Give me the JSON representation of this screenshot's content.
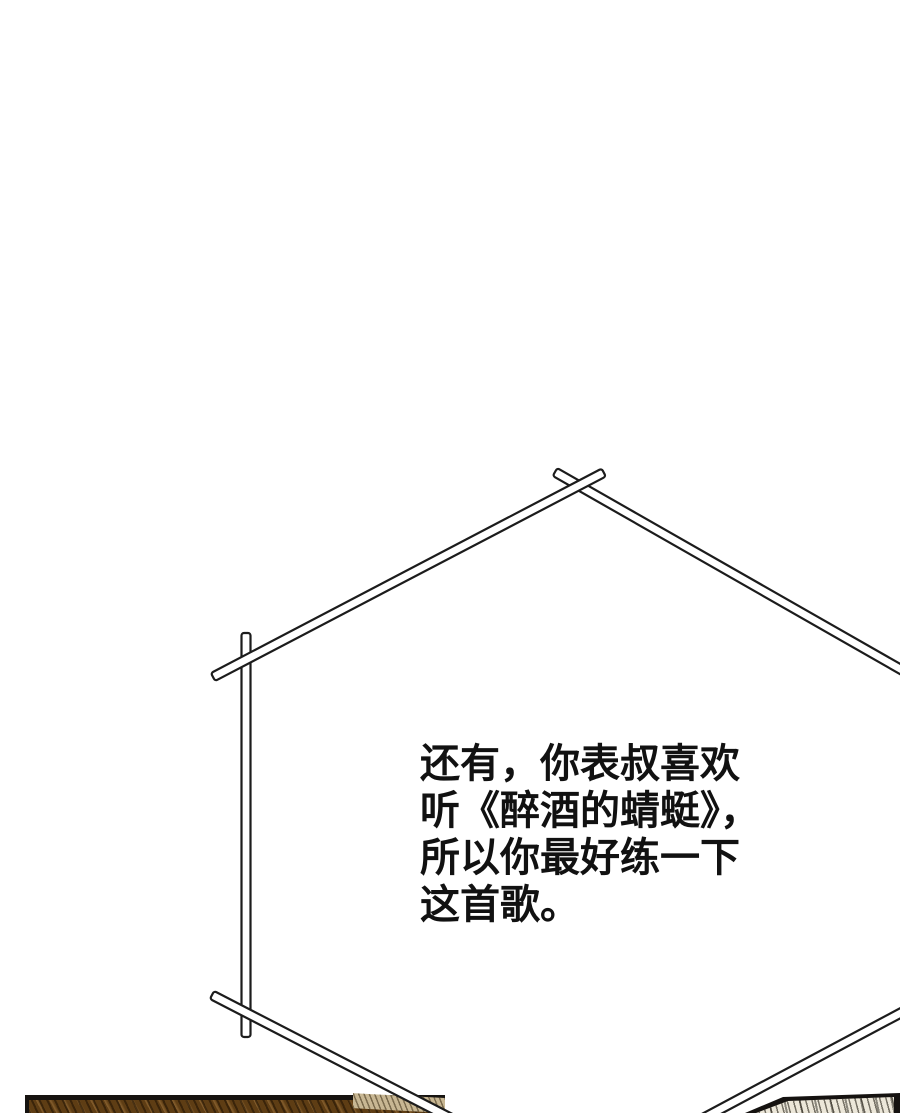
{
  "comic": {
    "bubble": {
      "lines": {
        "l1": "还有，你表叔喜欢",
        "l2": "听《醉酒的蜻蜓》，",
        "l3": "所以你最好练一下",
        "l4": "这首歌。"
      }
    },
    "colors": {
      "background": "#ffffff",
      "ink_outline": "#1c1c1c",
      "text": "#111111",
      "wood_dark": "#5e3d14",
      "wood_highlight": "#ce9c5c",
      "plank_tan": "#c8b793",
      "straw_light": "#ece7d9",
      "straw_stroke": "#282319",
      "panel_border": "#151210"
    }
  }
}
